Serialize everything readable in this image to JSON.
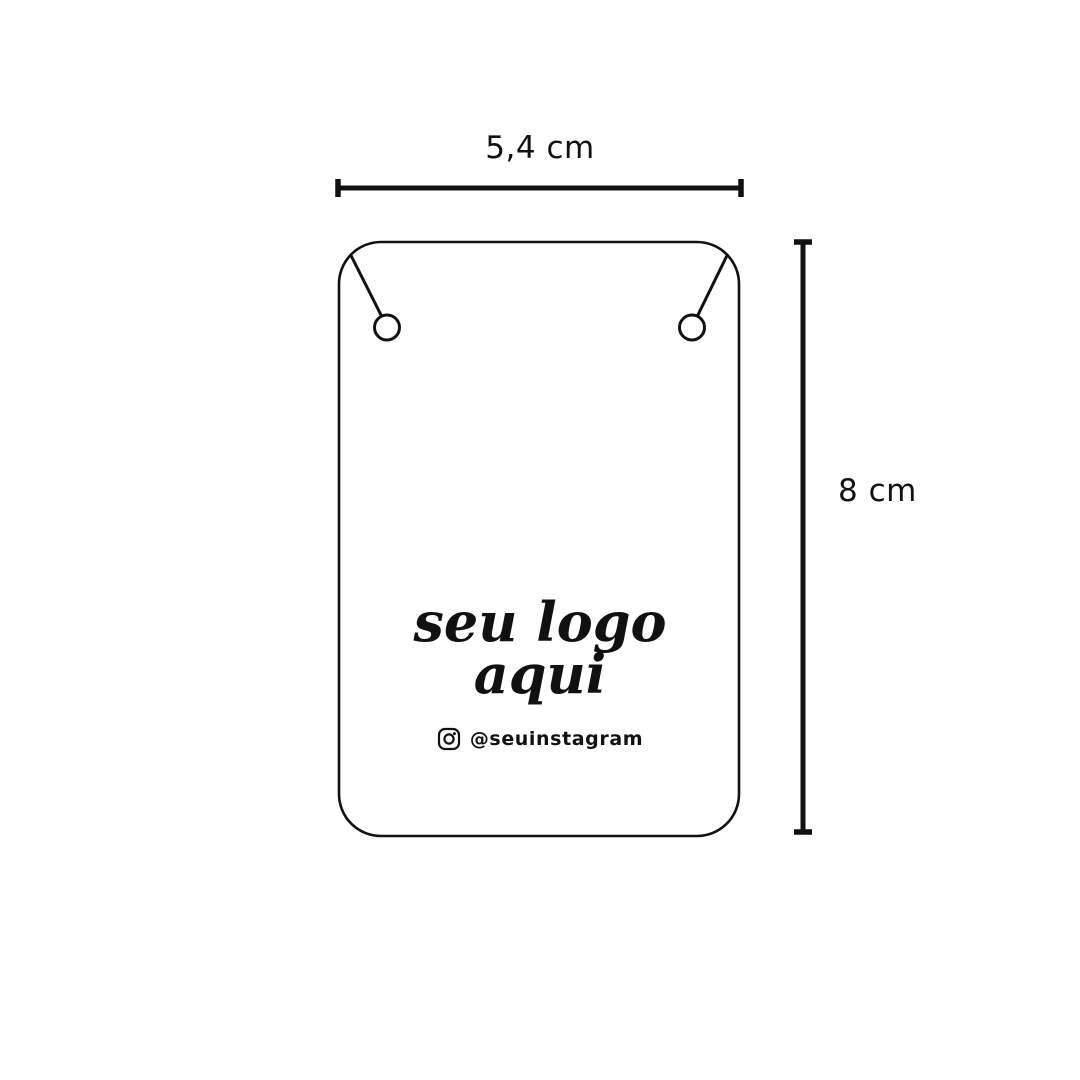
{
  "canvas": {
    "background_color": "#ffffff",
    "line_color": "#111111"
  },
  "dimensions": {
    "width_label": "5,4 cm",
    "height_label": "8 cm"
  },
  "card": {
    "logo_line1": "seu logo",
    "logo_line2": "aqui",
    "instagram_icon": "instagram-icon",
    "instagram_handle": "@seuinstagram"
  }
}
